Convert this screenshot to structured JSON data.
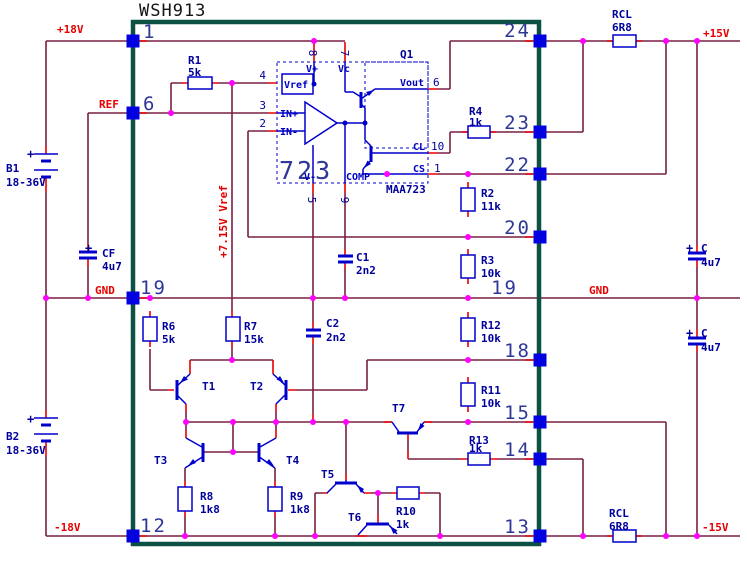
{
  "schematic_title": "WSH913",
  "ic": {
    "name": "723",
    "part": "MAA723",
    "output_stage": "Q1",
    "pin_labels": [
      "Vref",
      "IN+",
      "IN-",
      "V+",
      "Vc",
      "Vout",
      "CL",
      "CS",
      "V-",
      "COMP"
    ],
    "pin_numbers": [
      "4",
      "3",
      "2",
      "8",
      "7",
      "6",
      "10",
      "1",
      "5",
      "9"
    ]
  },
  "colors": {
    "wire": "#7a1f42",
    "lead": "#e80000",
    "component": "#0000cc",
    "pin_square": "#0000e0",
    "junction": "#ff00ff",
    "chip_outline": "#0d5044",
    "label_red": "#e60000",
    "label_navy": "#00009b"
  },
  "power_rails": [
    "+18V",
    "-18V",
    "+15V",
    "-15V",
    "GND",
    "REF",
    "+7.15V Vref"
  ],
  "components": {
    "batteries": [
      {
        "name": "B1",
        "value": "18-36V"
      },
      {
        "name": "B2",
        "value": "18-36V"
      }
    ],
    "resistors": [
      {
        "name": "R1",
        "value": "5k"
      },
      {
        "name": "R2",
        "value": "11k"
      },
      {
        "name": "R3",
        "value": "10k"
      },
      {
        "name": "R4",
        "value": "1k"
      },
      {
        "name": "R6",
        "value": "5k"
      },
      {
        "name": "R7",
        "value": "15k"
      },
      {
        "name": "R8",
        "value": "1k8"
      },
      {
        "name": "R9",
        "value": "1k8"
      },
      {
        "name": "R10",
        "value": "1k"
      },
      {
        "name": "R11",
        "value": "10k"
      },
      {
        "name": "R12",
        "value": "10k"
      },
      {
        "name": "R13",
        "value": "1k"
      },
      {
        "name": "RCL",
        "value": "6R8"
      },
      {
        "name": "RCL",
        "value": "6R8"
      }
    ],
    "capacitors": [
      {
        "name": "CF",
        "value": "4u7"
      },
      {
        "name": "C",
        "value": "4u7"
      },
      {
        "name": "C",
        "value": "4u7"
      },
      {
        "name": "C1",
        "value": "2n2"
      },
      {
        "name": "C2",
        "value": "2n2"
      }
    ],
    "transistors": [
      "T1",
      "T2",
      "T3",
      "T4",
      "T5",
      "T6",
      "T7"
    ]
  },
  "texts": [
    {
      "t": "WSH913",
      "x": 139,
      "y": 16,
      "c": "t-title",
      "n": "chip-title"
    },
    {
      "t": "+18V",
      "x": 57,
      "y": 33,
      "c": "t-red",
      "n": "rail-p18v"
    },
    {
      "t": "REF",
      "x": 99,
      "y": 108,
      "c": "t-red",
      "n": "rail-ref"
    },
    {
      "t": "GND",
      "x": 95,
      "y": 294,
      "c": "t-red",
      "n": "rail-gnd-left"
    },
    {
      "t": "GND",
      "x": 589,
      "y": 294,
      "c": "t-red",
      "n": "rail-gnd-right"
    },
    {
      "t": "+15V",
      "x": 703,
      "y": 37,
      "c": "t-red",
      "n": "rail-p15v"
    },
    {
      "t": "-15V",
      "x": 702,
      "y": 531,
      "c": "t-red",
      "n": "rail-m15v"
    },
    {
      "t": "-18V",
      "x": 54,
      "y": 531,
      "c": "t-red",
      "n": "rail-m18v"
    },
    {
      "t": "+7.15V Vref",
      "x": 227,
      "y": 258,
      "c": "t-red",
      "r": -90,
      "n": "rail-vref715"
    },
    {
      "t": "B1",
      "x": 6,
      "y": 172,
      "c": "t-navy",
      "n": "b1-name"
    },
    {
      "t": "18-36V",
      "x": 6,
      "y": 186,
      "c": "t-navy",
      "n": "b1-value"
    },
    {
      "t": "B2",
      "x": 6,
      "y": 440,
      "c": "t-navy",
      "n": "b2-name"
    },
    {
      "t": "18-36V",
      "x": 6,
      "y": 454,
      "c": "t-navy",
      "n": "b2-value"
    },
    {
      "t": "R1",
      "x": 188,
      "y": 64,
      "c": "t-navy",
      "n": "r1-name"
    },
    {
      "t": "5k",
      "x": 188,
      "y": 76,
      "c": "t-navy",
      "n": "r1-value"
    },
    {
      "t": "R4",
      "x": 469,
      "y": 115,
      "c": "t-navy",
      "n": "r4-name"
    },
    {
      "t": "1k",
      "x": 469,
      "y": 126,
      "c": "t-navy",
      "n": "r4-value"
    },
    {
      "t": "RCL",
      "x": 612,
      "y": 18,
      "c": "t-navy",
      "n": "rcl-top-name"
    },
    {
      "t": "6R8",
      "x": 612,
      "y": 31,
      "c": "t-navy",
      "n": "rcl-top-value"
    },
    {
      "t": "RCL",
      "x": 609,
      "y": 517,
      "c": "t-navy",
      "n": "rcl-bot-name"
    },
    {
      "t": "6R8",
      "x": 609,
      "y": 530,
      "c": "t-navy",
      "n": "rcl-bot-value"
    },
    {
      "t": "R2",
      "x": 481,
      "y": 197,
      "c": "t-navy",
      "n": "r2-name"
    },
    {
      "t": "11k",
      "x": 481,
      "y": 210,
      "c": "t-navy",
      "n": "r2-value"
    },
    {
      "t": "R3",
      "x": 481,
      "y": 264,
      "c": "t-navy",
      "n": "r3-name"
    },
    {
      "t": "10k",
      "x": 481,
      "y": 277,
      "c": "t-navy",
      "n": "r3-value"
    },
    {
      "t": "R12",
      "x": 481,
      "y": 329,
      "c": "t-navy",
      "n": "r12-name"
    },
    {
      "t": "10k",
      "x": 481,
      "y": 342,
      "c": "t-navy",
      "n": "r12-value"
    },
    {
      "t": "R11",
      "x": 481,
      "y": 394,
      "c": "t-navy",
      "n": "r11-name"
    },
    {
      "t": "10k",
      "x": 481,
      "y": 407,
      "c": "t-navy",
      "n": "r11-value"
    },
    {
      "t": "R13",
      "x": 469,
      "y": 444,
      "c": "t-navy",
      "n": "r13-name"
    },
    {
      "t": "1k",
      "x": 469,
      "y": 452,
      "c": "t-navy",
      "n": "r13-value"
    },
    {
      "t": "R10",
      "x": 396,
      "y": 515,
      "c": "t-navy",
      "n": "r10-name"
    },
    {
      "t": "1k",
      "x": 396,
      "y": 528,
      "c": "t-navy",
      "n": "r10-value"
    },
    {
      "t": "R6",
      "x": 162,
      "y": 330,
      "c": "t-navy",
      "n": "r6-name"
    },
    {
      "t": "5k",
      "x": 162,
      "y": 343,
      "c": "t-navy",
      "n": "r6-value"
    },
    {
      "t": "R7",
      "x": 244,
      "y": 330,
      "c": "t-navy",
      "n": "r7-name"
    },
    {
      "t": "15k",
      "x": 244,
      "y": 343,
      "c": "t-navy",
      "n": "r7-value"
    },
    {
      "t": "R8",
      "x": 200,
      "y": 500,
      "c": "t-navy",
      "n": "r8-name"
    },
    {
      "t": "1k8",
      "x": 200,
      "y": 513,
      "c": "t-navy",
      "n": "r8-value"
    },
    {
      "t": "R9",
      "x": 290,
      "y": 500,
      "c": "t-navy",
      "n": "r9-name"
    },
    {
      "t": "1k8",
      "x": 290,
      "y": 513,
      "c": "t-navy",
      "n": "r9-value"
    },
    {
      "t": "C1",
      "x": 356,
      "y": 261,
      "c": "t-navy",
      "n": "c1-name"
    },
    {
      "t": "2n2",
      "x": 356,
      "y": 274,
      "c": "t-navy",
      "n": "c1-value"
    },
    {
      "t": "C2",
      "x": 326,
      "y": 327,
      "c": "t-navy",
      "n": "c2-name"
    },
    {
      "t": "2n2",
      "x": 326,
      "y": 341,
      "c": "t-navy",
      "n": "c2-value"
    },
    {
      "t": "CF",
      "x": 102,
      "y": 257,
      "c": "t-navy",
      "n": "cf-name"
    },
    {
      "t": "4u7",
      "x": 102,
      "y": 270,
      "c": "t-navy",
      "n": "cf-value"
    },
    {
      "t": "C",
      "x": 701,
      "y": 252,
      "c": "t-navy",
      "n": "c-top-name"
    },
    {
      "t": "4u7",
      "x": 701,
      "y": 266,
      "c": "t-navy",
      "n": "c-top-value"
    },
    {
      "t": "+",
      "x": 686,
      "y": 252,
      "c": "t-plus",
      "n": "c-top-polarity"
    },
    {
      "t": "C",
      "x": 701,
      "y": 337,
      "c": "t-navy",
      "n": "c-bot-name"
    },
    {
      "t": "4u7",
      "x": 701,
      "y": 351,
      "c": "t-navy",
      "n": "c-bot-value"
    },
    {
      "t": "+",
      "x": 686,
      "y": 337,
      "c": "t-plus",
      "n": "c-bot-polarity"
    },
    {
      "t": "+",
      "x": 85,
      "y": 252,
      "c": "t-plus",
      "n": "cf-polarity"
    },
    {
      "t": "+",
      "x": 27,
      "y": 158,
      "c": "t-plus",
      "n": "b1-polarity"
    },
    {
      "t": "+",
      "x": 27,
      "y": 423,
      "c": "t-plus",
      "n": "b2-polarity"
    },
    {
      "t": "T1",
      "x": 202,
      "y": 390,
      "c": "t-navy",
      "n": "t1-name"
    },
    {
      "t": "T2",
      "x": 250,
      "y": 390,
      "c": "t-navy",
      "n": "t2-name"
    },
    {
      "t": "T3",
      "x": 154,
      "y": 464,
      "c": "t-navy",
      "n": "t3-name"
    },
    {
      "t": "T4",
      "x": 286,
      "y": 464,
      "c": "t-navy",
      "n": "t4-name"
    },
    {
      "t": "T5",
      "x": 321,
      "y": 478,
      "c": "t-navy",
      "n": "t5-name"
    },
    {
      "t": "T6",
      "x": 348,
      "y": 521,
      "c": "t-navy",
      "n": "t6-name"
    },
    {
      "t": "T7",
      "x": 392,
      "y": 412,
      "c": "t-navy",
      "n": "t7-name"
    },
    {
      "t": "Q1",
      "x": 400,
      "y": 58,
      "c": "t-navy",
      "n": "q1-name"
    },
    {
      "t": "MAA723",
      "x": 386,
      "y": 193,
      "c": "t-navy",
      "n": "ic-part-number"
    },
    {
      "t": "723",
      "x": 279,
      "y": 179,
      "c": "t-big",
      "n": "ic-name"
    },
    {
      "t": "Vref",
      "x": 284,
      "y": 88,
      "c": "t-ic",
      "n": "ic-label-vref"
    },
    {
      "t": "IN+",
      "x": 280,
      "y": 117,
      "c": "t-ic",
      "n": "ic-label-inp"
    },
    {
      "t": "IN-",
      "x": 280,
      "y": 135,
      "c": "t-ic",
      "n": "ic-label-inm"
    },
    {
      "t": "V+",
      "x": 306,
      "y": 72,
      "c": "t-ic",
      "n": "ic-label-vp"
    },
    {
      "t": "Vc",
      "x": 338,
      "y": 72,
      "c": "t-ic",
      "n": "ic-label-vc"
    },
    {
      "t": "Vout",
      "x": 400,
      "y": 86,
      "c": "t-ic",
      "n": "ic-label-vout"
    },
    {
      "t": "CL",
      "x": 413,
      "y": 150,
      "c": "t-ic",
      "n": "ic-label-cl"
    },
    {
      "t": "CS",
      "x": 413,
      "y": 172,
      "c": "t-ic",
      "n": "ic-label-cs"
    },
    {
      "t": "V-",
      "x": 304,
      "y": 180,
      "c": "t-ic",
      "n": "ic-label-vm"
    },
    {
      "t": "COMP",
      "x": 346,
      "y": 180,
      "c": "t-ic",
      "n": "ic-label-comp"
    },
    {
      "t": "1",
      "x": 143,
      "y": 38,
      "c": "t-pin",
      "n": "pin-1"
    },
    {
      "t": "6",
      "x": 143,
      "y": 110,
      "c": "t-pin",
      "n": "pin-6"
    },
    {
      "t": "19",
      "x": 140,
      "y": 294,
      "c": "t-pin",
      "n": "pin-19-left"
    },
    {
      "t": "12",
      "x": 140,
      "y": 532,
      "c": "t-pin",
      "n": "pin-12"
    },
    {
      "t": "24",
      "x": 531,
      "y": 37,
      "c": "t-pin",
      "a": "end",
      "n": "pin-24"
    },
    {
      "t": "23",
      "x": 531,
      "y": 129,
      "c": "t-pin",
      "a": "end",
      "n": "pin-23"
    },
    {
      "t": "22",
      "x": 531,
      "y": 171,
      "c": "t-pin",
      "a": "end",
      "n": "pin-22"
    },
    {
      "t": "20",
      "x": 531,
      "y": 234,
      "c": "t-pin",
      "a": "end",
      "n": "pin-20"
    },
    {
      "t": "19",
      "x": 518,
      "y": 294,
      "c": "t-pin",
      "a": "end",
      "n": "pin-19-right"
    },
    {
      "t": "18",
      "x": 531,
      "y": 357,
      "c": "t-pin",
      "a": "end",
      "n": "pin-18"
    },
    {
      "t": "15",
      "x": 531,
      "y": 419,
      "c": "t-pin",
      "a": "end",
      "n": "pin-15"
    },
    {
      "t": "14",
      "x": 531,
      "y": 456,
      "c": "t-pin",
      "a": "end",
      "n": "pin-14"
    },
    {
      "t": "13",
      "x": 531,
      "y": 533,
      "c": "t-pin",
      "a": "end",
      "n": "pin-13"
    },
    {
      "t": "4",
      "x": 266,
      "y": 79,
      "c": "t-icpin",
      "a": "end",
      "n": "icpin-4"
    },
    {
      "t": "3",
      "x": 266,
      "y": 109,
      "c": "t-icpin",
      "a": "end",
      "n": "icpin-3"
    },
    {
      "t": "2",
      "x": 266,
      "y": 127,
      "c": "t-icpin",
      "a": "end",
      "n": "icpin-2"
    },
    {
      "t": "6",
      "x": 433,
      "y": 86,
      "c": "t-icpin",
      "n": "icpin-6"
    },
    {
      "t": "10",
      "x": 431,
      "y": 150,
      "c": "t-icpin",
      "n": "icpin-10"
    },
    {
      "t": "1",
      "x": 434,
      "y": 172,
      "c": "t-icpin",
      "n": "icpin-1"
    },
    {
      "t": "8",
      "x": 309,
      "y": 53,
      "c": "t-icpin",
      "r": 90,
      "a": "middle",
      "n": "icpin-8"
    },
    {
      "t": "7",
      "x": 341,
      "y": 53,
      "c": "t-icpin",
      "r": 90,
      "a": "middle",
      "n": "icpin-7"
    },
    {
      "t": "5",
      "x": 308,
      "y": 200,
      "c": "t-icpin",
      "r": 90,
      "a": "middle",
      "n": "icpin-5"
    },
    {
      "t": "9",
      "x": 341,
      "y": 200,
      "c": "t-icpin",
      "r": 90,
      "a": "middle",
      "n": "icpin-9"
    }
  ],
  "pin_squares": [
    [
      133,
      41
    ],
    [
      133,
      113
    ],
    [
      133,
      298
    ],
    [
      133,
      536
    ],
    [
      540,
      41
    ],
    [
      540,
      132
    ],
    [
      540,
      174
    ],
    [
      540,
      237
    ],
    [
      540,
      360
    ],
    [
      540,
      422
    ],
    [
      540,
      459
    ],
    [
      540,
      536
    ]
  ],
  "junction_dots": [
    [
      314,
      41
    ],
    [
      583,
      41
    ],
    [
      666,
      41
    ],
    [
      697,
      41
    ],
    [
      171,
      113
    ],
    [
      232,
      83
    ],
    [
      46,
      298
    ],
    [
      88,
      298
    ],
    [
      150,
      298
    ],
    [
      313,
      298
    ],
    [
      345,
      298
    ],
    [
      468,
      298
    ],
    [
      697,
      298
    ],
    [
      387,
      174
    ],
    [
      468,
      174
    ],
    [
      468,
      237
    ],
    [
      232,
      360
    ],
    [
      468,
      360
    ],
    [
      186,
      422
    ],
    [
      233,
      422
    ],
    [
      276,
      422
    ],
    [
      313,
      422
    ],
    [
      346,
      422
    ],
    [
      468,
      422
    ],
    [
      233,
      452
    ],
    [
      378,
      493
    ],
    [
      185,
      536
    ],
    [
      275,
      536
    ],
    [
      315,
      536
    ],
    [
      440,
      536
    ],
    [
      583,
      536
    ],
    [
      666,
      536
    ],
    [
      697,
      536
    ]
  ],
  "blue_dots": [
    [
      314,
      84
    ],
    [
      345,
      123
    ],
    [
      365,
      123
    ]
  ]
}
